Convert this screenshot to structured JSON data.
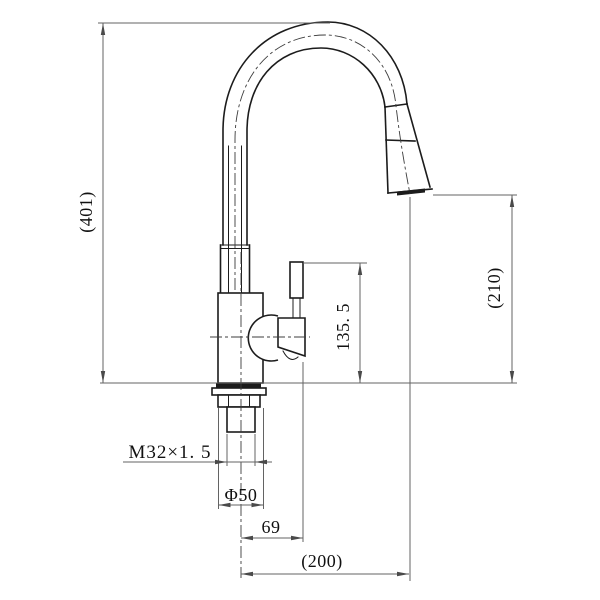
{
  "canvas": {
    "background": "#ffffff",
    "object_line_color": "#1c1c1c",
    "dimension_line_color": "#636363"
  },
  "drawing": {
    "dimensions": {
      "overall_height": "(401)",
      "spout_clearance": "(210)",
      "handle_height": "135. 5",
      "thread_spec": "M32×1. 5",
      "base_diameter": "Φ50",
      "handle_reach": "69",
      "spout_reach": "(200)"
    }
  }
}
